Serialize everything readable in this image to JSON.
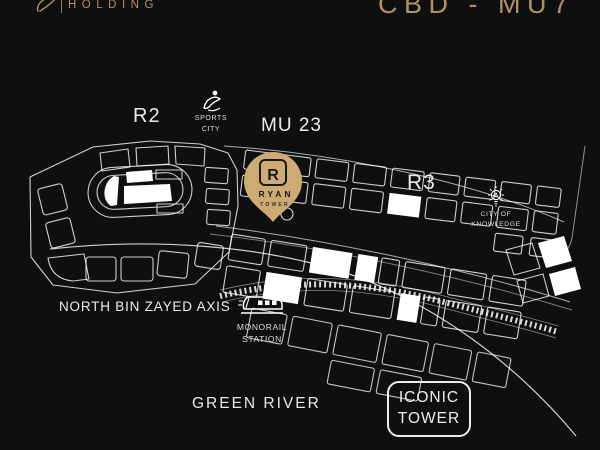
{
  "colors": {
    "background": "#0e0f11",
    "gold": "#b2915e",
    "pin_gold": "#cfab74",
    "map_lines": "#ffffff",
    "label_white": "#ebebeb"
  },
  "header": {
    "brand_word": "HOLDING",
    "project_code": "CBD - MU7"
  },
  "map": {
    "districts": {
      "r2": "R2",
      "mu23": "MU 23",
      "r3": "R3"
    },
    "landmarks": {
      "sports_city": {
        "line1": "SPORTS",
        "line2": "CITY"
      },
      "city_of_knowledge": {
        "line1": "CITY OF",
        "line2": "KNOWLEDGE"
      },
      "monorail_station": {
        "line1": "MONORAIL",
        "line2": "STATION"
      },
      "north_axis": {
        "label": "NORTH BIN ZAYED AXIS"
      },
      "green_river": {
        "label": "GREEN RIVER"
      },
      "iconic_tower": {
        "line1": "ICONIC",
        "line2": "TOWER"
      }
    },
    "pin": {
      "monogram": "R",
      "brand": "RYAN",
      "sub": "TOWER"
    }
  },
  "icons": {
    "sports_city": "gymnast-icon",
    "city_of_knowledge": "lightbulb-icon",
    "monorail_station": "train-icon",
    "pin": "map-pin-icon"
  }
}
